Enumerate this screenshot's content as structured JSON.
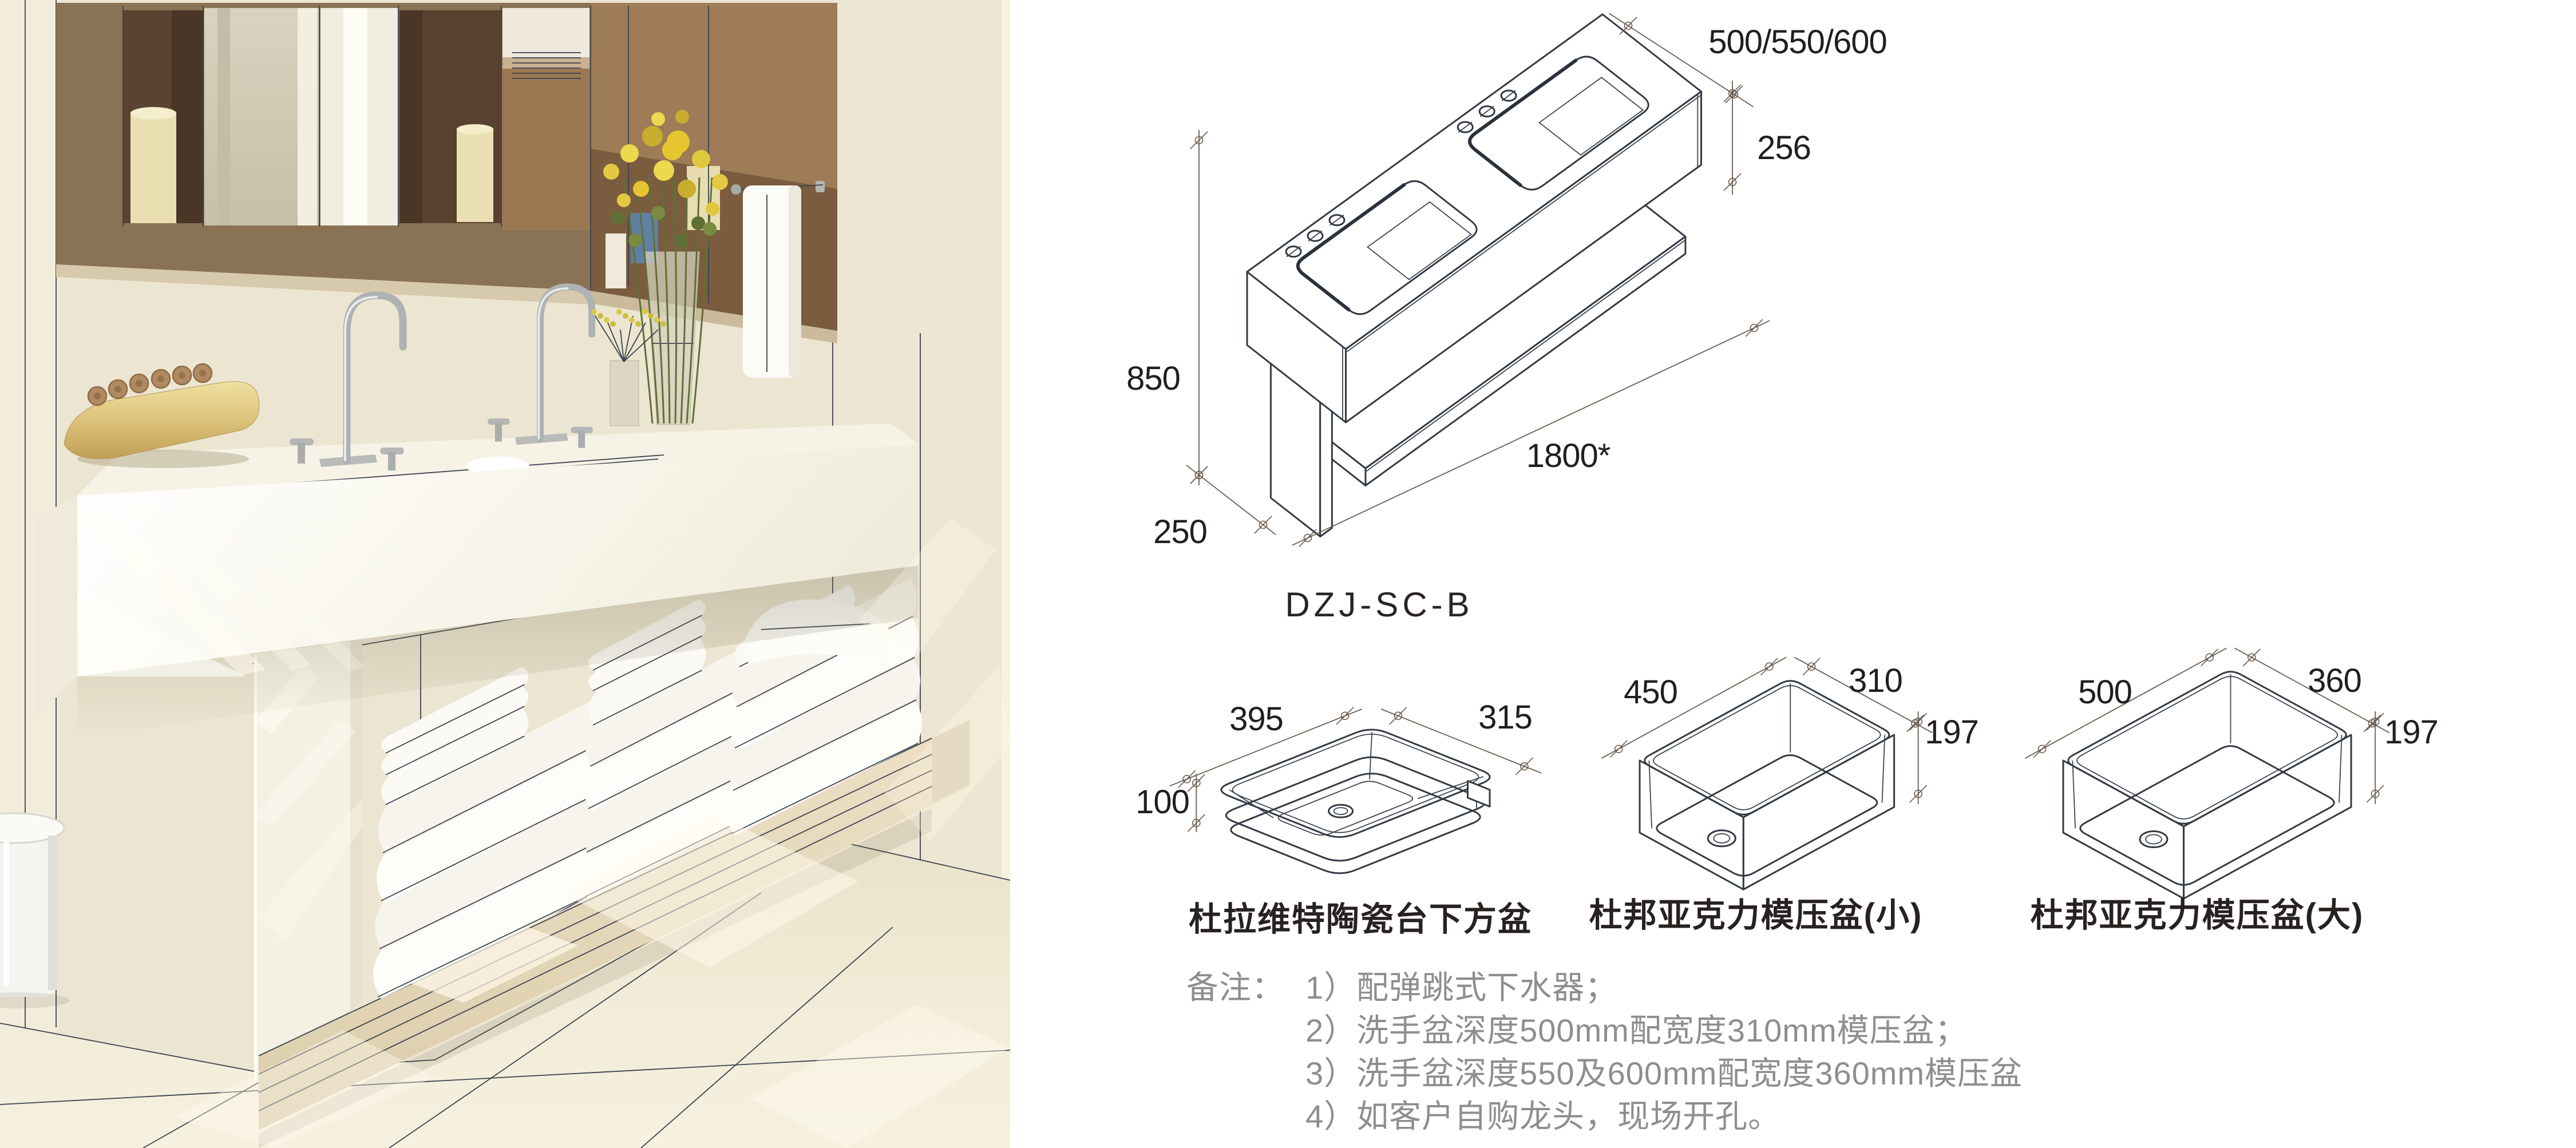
{
  "colors": {
    "drawing_line": "#333a45",
    "dimension_line": "#6b5c50",
    "dimension_text": "#221e1d",
    "note_text": "#8e8e8e",
    "caption_text": "#272220",
    "photo_wall": "#ece5d1",
    "wood_shelf": "#e8dcc2",
    "flower_yellow": "#e3c93f"
  },
  "main_drawing": {
    "model": "DZJ-SC-B",
    "dim_depth": "500/550/600",
    "dim_counter_height": "256",
    "dim_total_height": "850",
    "dim_leg_depth": "250",
    "dim_length": "1800*"
  },
  "basins": [
    {
      "caption": "杜拉维特陶瓷台下方盆",
      "dim_width": "395",
      "dim_depth": "315",
      "dim_height": "100"
    },
    {
      "caption": "杜邦亚克力模压盆(小)",
      "dim_width": "450",
      "dim_depth": "310",
      "dim_height": "197"
    },
    {
      "caption": "杜邦亚克力模压盆(大)",
      "dim_width": "500",
      "dim_depth": "360",
      "dim_height": "197"
    }
  ],
  "notes": {
    "label": "备注：",
    "items": [
      "1）配弹跳式下水器；",
      "2）洗手盆深度500mm配宽度310mm模压盆；",
      "3）洗手盆深度550及600mm配宽度360mm模压盆",
      "4）如客户自购龙头，现场开孔。"
    ]
  }
}
